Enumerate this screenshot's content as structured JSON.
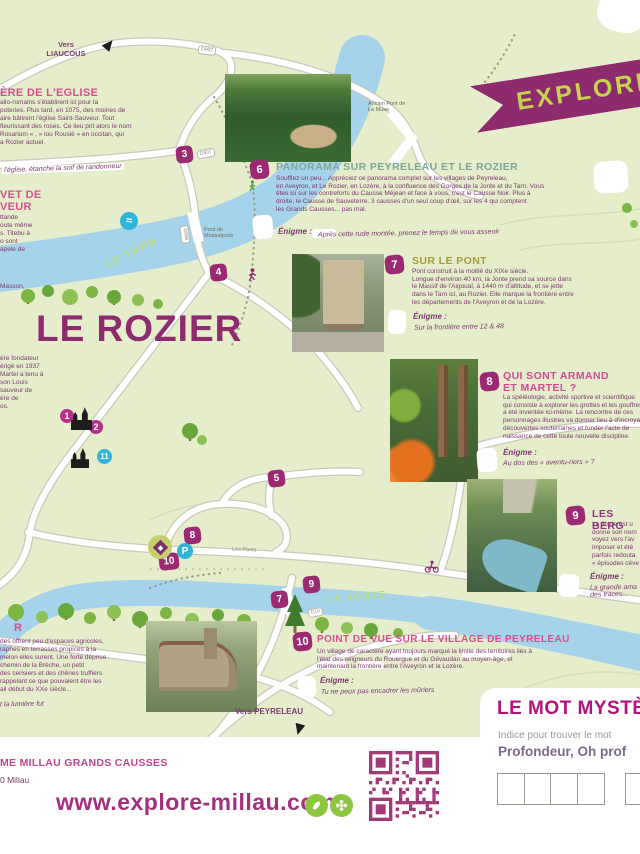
{
  "map": {
    "title": "LE ROZIER",
    "rivers": {
      "tarn": "LE TARN",
      "jonte": "LA JONTE"
    },
    "directions": {
      "liaucous": "Vers\nLIAUCOUS",
      "peyreleau": "Vers PEYRELEAU"
    },
    "bridges": {
      "muse": "Ancien Pont de\nLa Muse",
      "mostuejouls": "Pont de\nMostuéjouls"
    },
    "road_labels": {
      "d907_top": "D907",
      "d907_mid": "D907",
      "d996": "D996",
      "d16": "D16",
      "les_ponts": "Les Ponts"
    },
    "markers": {
      "m1": "1",
      "m2": "2",
      "m3": "3",
      "m4": "4",
      "m5": "5",
      "m7": "7",
      "m8": "8",
      "m9": "9",
      "m10": "10",
      "m11": "11",
      "parking": "P",
      "waves": "≈"
    }
  },
  "left_column": {
    "block_church": {
      "heading": "ÈRE DE L'EGLISE",
      "body": "allo-romains s'établirent ici pour la\npoteries. Plus tard, en 1075, des moines de\naire bâtirent l'église Saint-Sauveur. Tout\nfleurissant des roses. Ce lieu prit alors le nom\nRosarium « , » lou Rousiè » en occitan, qui\na Rozier actuel.",
      "note": "l'église, étanche la soif de randonneur"
    },
    "block_chevet": {
      "heading": "VET DE\nVEUR",
      "body": "ttande\noute même\ns. Titebu à\no sont\napele de",
      "note": "Masson,"
    },
    "block_fondateur": {
      "body": "ère fondateur\nérigé en 1937\nMartel a tenu à\nson Louis\nsauveur de\nère de\nos."
    },
    "block_terrasses": {
      "heading": "R",
      "body": "des offrent peu d'espaces agricoles,\nraphes en terrasses propices à la\nmelon elles surent. Une forte déprise\nchemin de la Brèche, un petit\ndes cerisiers et des chênes truffiers\nrappelant ce que pouvaient être les\nail début du XXe siècle...",
      "note": "t la lumière fut"
    }
  },
  "panels": [
    {
      "number": "6",
      "title": "PANORAMA SUR PEYRELEAU ET LE ROZIER",
      "title_color": "#7ca899",
      "body": "Soufflez un peu... Appréciez ce panorama complet sur les villages de Peyreleau,\nen Aveyron, et Le Rozier, en Lozère, à la confluence des Gorges de la Jonte et du Tarn. Vous\nêtes ici sur les contreforts du Causse Méjean et face à vous, c'est le Causse Noir. Plus à\ndroite, le Causse de Sauveterre. 3 causses d'un seul coup d'œil, sur les 4 qui comptent\nles Grands Causses... pas mal.",
      "enigme_label": "Énigme :",
      "enigme": "Après cette rude montée, prenez le temps de vous asseoir"
    },
    {
      "number": "7",
      "title": "SUR LE PONT",
      "title_color": "#a39b3f",
      "body": "Pont construit à la moitié du XIXe siècle.\nLongue d'environ 40 km, la Jonte prend sa source dans\nle Massif de l'Aigoual, à 1440 m d'altitude, et se jette\ndans le Tarn ici, au Rozier. Elle marque la frontière entre\nles départements de l'Aveyron et de la Lozère.",
      "enigme_label": "Énigme :",
      "enigme": "Sur la frontière entre 12 & 48"
    },
    {
      "number": "8",
      "title": "QUI SONT ARMAND\nET MARTEL ?",
      "title_color": "#cf4b96",
      "body": "La spéléologie, activité sportive et scientifique\nqui consiste à explorer les grottes et les gouffres,\na été inventée ici-même. La rencontre de ces\npersonnages illustres va donner lieu à d'incroyables\ndécouvertes souterraines et fonder l'acte de\nnaissance de cette toute nouvelle discipline.",
      "enigme_label": "Énigme :",
      "enigme": "Au dos des « aventu-riers » ?"
    },
    {
      "number": "9",
      "title": "LES BERG",
      "title_color": "#93347e",
      "body": "La Jonte est u\ndonne son nom\nvoyez vers l'av\nimposer et été\nparfois redouta\n« épisodes céve",
      "enigme_label": "Énigme :",
      "enigme": "La grande ama\ndes traces..."
    },
    {
      "number": "10",
      "title": "POINT DE VUE SUR LE VILLAGE DE PEYRELEAU",
      "title_color": "#d4518e",
      "body": "Un village de caractère ayant toujours marqué la limite des territoires liés à\nl'état des seigneurs du Rouergue et du Gévaudan au moyen-âge, et\nmaintenant la frontière entre l'Aveyron et la Lozère.",
      "enigme_label": "Énigme :",
      "enigme": "Tu ne peux pas encadrer les mûriers"
    }
  ],
  "ribbon": {
    "label": "EXPLORE"
  },
  "footer": {
    "org": "ME MILLAU GRANDS CAUSSES",
    "address": "0 Millau",
    "website": "www.explore-millau.com"
  },
  "mystery": {
    "title": "LE MOT MYSTÈRE",
    "hint": "Indice pour trouver le mot",
    "clue": "Profondeur, Oh prof"
  },
  "colors": {
    "purple": "#8e2a6e",
    "pink": "#d4518e",
    "magenta": "#b5117e",
    "cyan": "#2fb4dc",
    "river": "#a5d3eb",
    "map_bg": "#e5edcb",
    "green": "#8dc63f",
    "ribbon_text": "#c5d34f"
  }
}
